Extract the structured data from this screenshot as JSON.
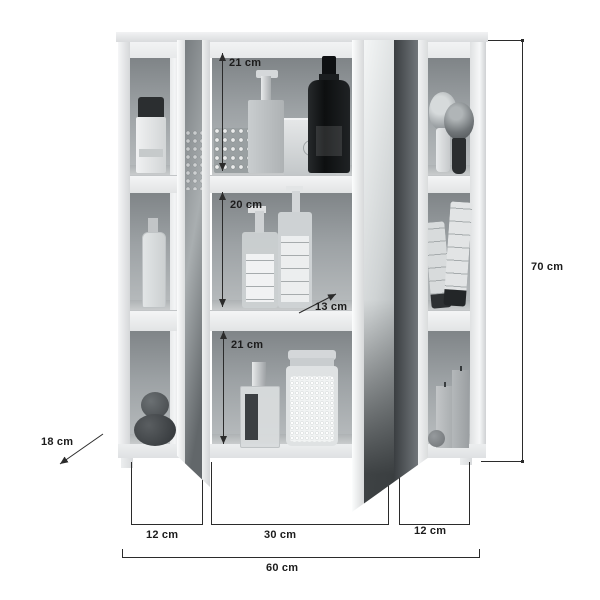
{
  "dimensions": {
    "top_compartment_height": "21 cm",
    "middle_compartment_height": "20 cm",
    "bottom_compartment_height": "21 cm",
    "shelf_depth": "13 cm",
    "cabinet_depth": "18 cm",
    "total_height": "70 cm",
    "total_width": "60 cm",
    "left_section_width": "12 cm",
    "center_section_width": "30 cm",
    "right_section_width": "12 cm"
  },
  "colors": {
    "background": "#ffffff",
    "dimension_line": "#2b2b2b",
    "label_text": "#1c1c1c",
    "cabinet_body": "#eef0f1",
    "interior_back_dark": "#7f8487",
    "interior_back_light": "#b9bdbf",
    "mirror_dark": "#3a3e41",
    "mirror_light": "#f4f6f6"
  }
}
